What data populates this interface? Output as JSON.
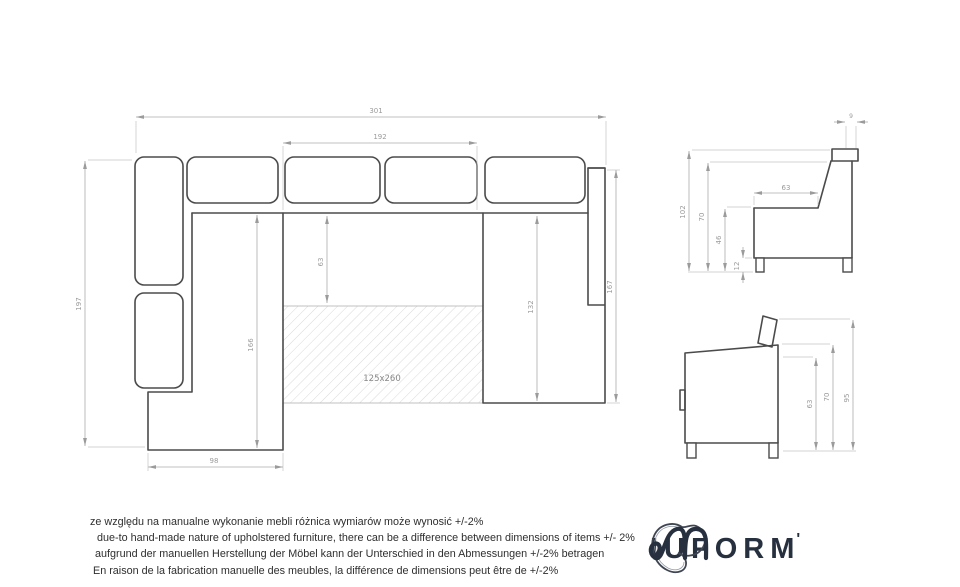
{
  "top_view": {
    "bed_label": "125x260",
    "dims": {
      "total_width": "301",
      "seat_span": "192",
      "left_depth": "197",
      "left_inner": "166",
      "back_depth": "63",
      "chaise_inner": "132",
      "chaise_depth": "167",
      "wing_width": "98"
    }
  },
  "side_view": {
    "dims": {
      "headrest_width": "9",
      "total_height": "102",
      "back_height": "70",
      "seat_height": "46",
      "leg_height": "12",
      "seat_depth": "63"
    }
  },
  "front_view": {
    "dims": {
      "body_height": "63",
      "arm_height": "70",
      "headrest_height": "95"
    }
  },
  "disclaimer": {
    "pl": "ze względu na manualne wykonanie mebli różnica wymiarów może wynosić +/-2%",
    "en": "due-to hand-made nature of upholstered furniture, there can be a difference between dimensions of items +/- 2%",
    "de": "aufgrund der manuellen Herstellung der Möbel kann der Unterschied in den Abmessungen +/-2% betragen",
    "fr": "En raison de la fabrication manuelle des meubles, la différence de dimensions peut être de +/-2%"
  },
  "brand": {
    "wordmark_tail": "IUFORM",
    "suffix": "'",
    "color": "#27303f"
  },
  "colors": {
    "outline": "#4b4b4b",
    "dimension_lines": "#ababab",
    "dimension_text": "#9b9b9b",
    "hatch": "#cfcfcf"
  }
}
